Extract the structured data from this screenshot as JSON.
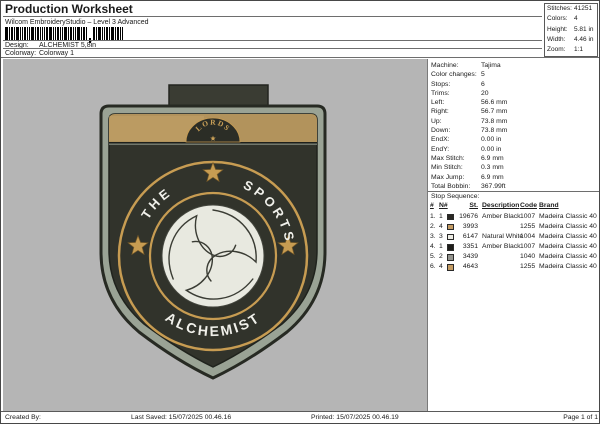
{
  "header": {
    "title": "Production Worksheet",
    "subtitle": "Wilcom EmbroideryStudio – Level 3 Advanced",
    "design_label": "Design:",
    "design_value": "ALCHEMIST 5,8in",
    "colorway_label": "Colorway:",
    "colorway_value": "Colorway 1"
  },
  "summary_box": {
    "rows": [
      {
        "label": "Stitches:",
        "value": "41251"
      },
      {
        "label": "Colors:",
        "value": "4"
      },
      {
        "label": "Height:",
        "value": "5.81 in"
      },
      {
        "label": "Width:",
        "value": "4.46 in"
      },
      {
        "label": "Zoom:",
        "value": "1:1"
      }
    ]
  },
  "machine_info": {
    "rows": [
      {
        "label": "Machine:",
        "value": "Tajima"
      },
      {
        "label": "Color changes:",
        "value": "5"
      },
      {
        "label": "Stops:",
        "value": "6"
      },
      {
        "label": "Trims:",
        "value": "20"
      },
      {
        "label": "Left:",
        "value": "56.6 mm"
      },
      {
        "label": "Right:",
        "value": "56.7 mm"
      },
      {
        "label": "Up:",
        "value": "73.8 mm"
      },
      {
        "label": "Down:",
        "value": "73.8 mm"
      },
      {
        "label": "EndX:",
        "value": "0.00 in"
      },
      {
        "label": "EndY:",
        "value": "0.00 in"
      },
      {
        "label": "Max Stitch:",
        "value": "6.9 mm"
      },
      {
        "label": "Min Stitch:",
        "value": "0.3 mm"
      },
      {
        "label": "Max Jump:",
        "value": "6.9 mm"
      },
      {
        "label": "Total Bobbin:",
        "value": "367.99ft"
      }
    ]
  },
  "stop_sequence": {
    "title": "Stop Sequence:",
    "headers": {
      "num": "#",
      "n": "N#",
      "st": "St.",
      "description": "Description",
      "code": "Code",
      "brand": "Brand"
    },
    "rows": [
      {
        "num": "1.",
        "thread_num": "1",
        "swatch_color": "#2b2824",
        "stitches": "19676",
        "description": "Amber Black",
        "code": "1007",
        "brand": "Madeira Classic 40"
      },
      {
        "num": "2.",
        "thread_num": "4",
        "swatch_color": "#c39b63",
        "stitches": "3993",
        "description": "",
        "code": "1255",
        "brand": "Madeira Classic 40"
      },
      {
        "num": "3.",
        "thread_num": "3",
        "swatch_color": "#ecebe3",
        "stitches": "6147",
        "description": "Natural White",
        "code": "1004",
        "brand": "Madeira Classic 40"
      },
      {
        "num": "4.",
        "thread_num": "1",
        "swatch_color": "#1f1d1a",
        "stitches": "3351",
        "description": "Amber Black",
        "code": "1007",
        "brand": "Madeira Classic 40"
      },
      {
        "num": "5.",
        "thread_num": "2",
        "swatch_color": "#94948e",
        "stitches": "3439",
        "description": "",
        "code": "1040",
        "brand": "Madeira Classic 40"
      },
      {
        "num": "6.",
        "thread_num": "4",
        "swatch_color": "#c39b63",
        "stitches": "4643",
        "description": "",
        "code": "1255",
        "brand": "Madeira Classic 40"
      }
    ]
  },
  "design_preview": {
    "badge": {
      "band_text": "LORDS",
      "arc_text_left": "THE",
      "arc_text_right": "SPORTS",
      "arc_text_bottom": "ALCHEMIST",
      "colors": {
        "canvas_background": "#b5b5b5",
        "body": "#31332b",
        "border_band": "#9aa395",
        "top_band": "#b2935c",
        "gold": "#c79c52",
        "ball": "#e8e9e0",
        "text": "#f0f0ea",
        "tab": "#3a3c33"
      }
    }
  },
  "footer": {
    "created_by": "Created By:",
    "last_saved": "Last Saved: 15/07/2025 00.46.16",
    "printed": "Printed: 15/07/2025 00.46.19",
    "page": "Page 1 of 1"
  }
}
